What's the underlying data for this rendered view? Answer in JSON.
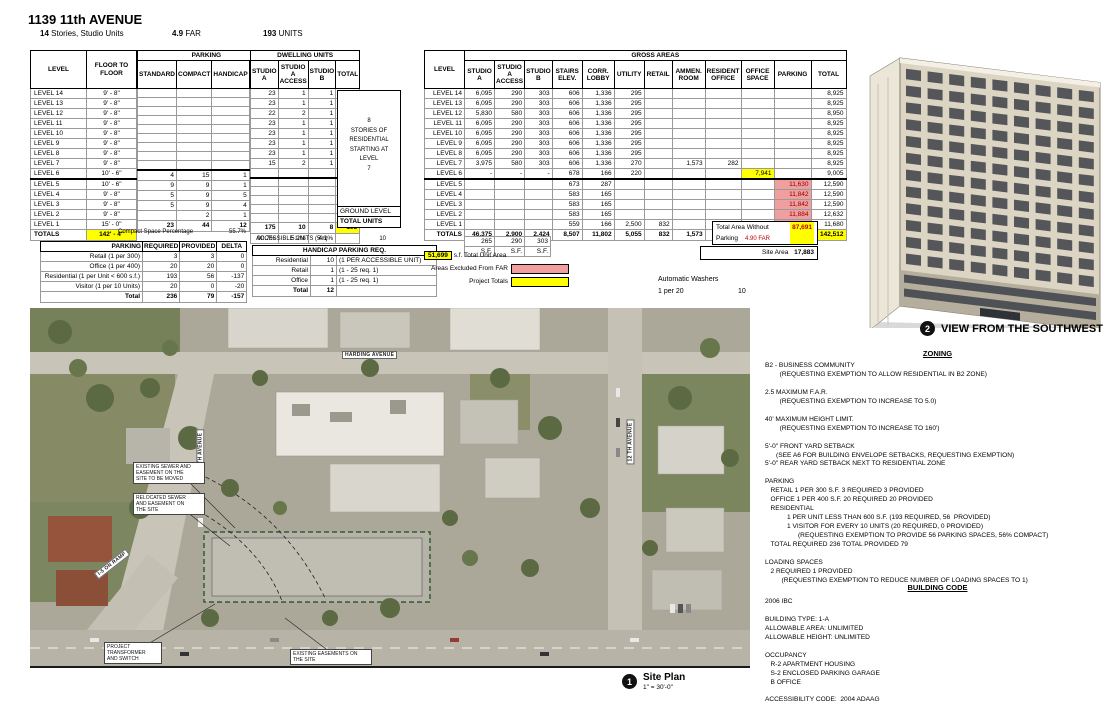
{
  "header": {
    "title": "1139 11th AVENUE",
    "stories_value": "14",
    "stories_label": "Stories, Studio Units",
    "far_value": "4.9",
    "far_label": "FAR",
    "units_value": "193",
    "units_label": "UNITS"
  },
  "tables": {
    "levels": {
      "col_level": "LEVEL",
      "col_floor": "FLOOR TO\nFLOOR",
      "rows": [
        [
          "LEVEL 14",
          "9' - 8\""
        ],
        [
          "LEVEL 13",
          "9' - 8\""
        ],
        [
          "LEVEL 12",
          "9' - 8\""
        ],
        [
          "LEVEL 11",
          "9' - 8\""
        ],
        [
          "LEVEL 10",
          "9' - 8\""
        ],
        [
          "LEVEL 9",
          "9' - 8\""
        ],
        [
          "LEVEL 8",
          "9' - 8\""
        ],
        [
          "LEVEL 7",
          "9' - 8\""
        ],
        [
          "LEVEL 6",
          "10' - 6\""
        ],
        {
          "c": "brk",
          "cells": [
            "LEVEL 5",
            "10' - 6\""
          ]
        },
        [
          "LEVEL 4",
          "9' - 8\""
        ],
        [
          "LEVEL 3",
          "9' - 8\""
        ],
        [
          "LEVEL 2",
          "9' - 8\""
        ],
        [
          "LEVEL 1",
          "15' - 0\""
        ],
        {
          "c": "tot",
          "cells": [
            "TOTALS",
            {
              "v": "142' - 4\"",
              "c": "hl-y"
            }
          ]
        }
      ]
    },
    "parking": {
      "title": "PARKING",
      "columns": [
        "STANDARD",
        "COMPACT",
        "HANDICAP",
        ""
      ],
      "rows": [
        [
          "",
          "",
          "",
          ""
        ],
        [
          "",
          "",
          "",
          ""
        ],
        [
          "",
          "",
          "",
          ""
        ],
        [
          "",
          "",
          "",
          ""
        ],
        [
          "",
          "",
          "",
          ""
        ],
        [
          "",
          "",
          "",
          ""
        ],
        [
          "",
          "",
          "",
          ""
        ],
        [
          "",
          "",
          "",
          ""
        ],
        [
          "",
          "",
          "",
          ""
        ],
        {
          "c": "brk",
          "cells": [
            "4",
            "15",
            "1",
            "20"
          ]
        },
        [
          "9",
          "9",
          "1",
          "19"
        ],
        [
          "5",
          "9",
          "5",
          "19"
        ],
        [
          "5",
          "9",
          "4",
          "18"
        ],
        [
          "",
          "2",
          "1",
          "3"
        ],
        {
          "c": "tot",
          "cells": [
            "23",
            "44",
            "12",
            {
              "v": "79",
              "c": "hl-y"
            }
          ]
        }
      ],
      "compact_label": "Compact Space Percentage",
      "compact_value": "55.7%"
    },
    "dwelling": {
      "title": "DWELLING UNITS",
      "columns": [
        "STUDIO\nA",
        "STUDIO\nA\nACCESS",
        "STUDIO\nB",
        "TOTAL"
      ],
      "rows": [
        [
          "23",
          "1",
          "1",
          "25"
        ],
        [
          "23",
          "1",
          "1",
          "25"
        ],
        [
          "22",
          "2",
          "1",
          "25"
        ],
        [
          "23",
          "1",
          "1",
          "25"
        ],
        [
          "23",
          "1",
          "1",
          "25"
        ],
        [
          "23",
          "1",
          "1",
          "25"
        ],
        [
          "23",
          "1",
          "1",
          "25"
        ],
        [
          "15",
          "2",
          "1",
          "18"
        ],
        [
          "",
          "",
          "",
          ""
        ],
        {
          "c": "brk",
          "cells": [
            "",
            "",
            "",
            ""
          ]
        },
        [
          "",
          "",
          "",
          ""
        ],
        [
          "",
          "",
          "",
          ""
        ],
        [
          "",
          "",
          "",
          ""
        ],
        [
          "",
          "",
          "",
          ""
        ],
        {
          "c": "tot",
          "cells": [
            "175",
            "10",
            "8",
            {
              "v": "193",
              "c": "hl-y"
            }
          ]
        },
        {
          "c": "pct",
          "cells": [
            "90.7%",
            "5.2%",
            "4.1%",
            ""
          ]
        }
      ],
      "note": "8\nSTORIES OF\nRESIDENTIAL\nSTARTING AT\nLEVEL\n7",
      "ground_label": "GROUND LEVEL",
      "total_units_label": "TOTAL UNITS"
    },
    "parking_req": {
      "columns": [
        "PARKING",
        "REQUIRED",
        "PROVIDED",
        "DELTA"
      ],
      "rows": [
        [
          "Retail (1 per 300)",
          "3",
          "3",
          "0"
        ],
        [
          "Office (1 per 400)",
          "20",
          "20",
          "0"
        ],
        [
          "Residential (1 per Unit < 600 s.f.)",
          "193",
          "56",
          "-137"
        ],
        [
          "Visitor (1 per 10 Units)",
          "20",
          "0",
          "-20"
        ],
        {
          "c": "tot",
          "cells": [
            "Total",
            "236",
            "79",
            "-157"
          ]
        }
      ]
    },
    "accessible": {
      "label": "ACCESSIBLE UNITS (5%)",
      "value": "10"
    },
    "handicap": {
      "title": "HANDICAP PARKING REQ.",
      "rows": [
        [
          "Residential",
          "10",
          "(1 PER ACCESSIBLE UNIT)"
        ],
        [
          "Retail",
          "1",
          "(1 - 25 req. 1)"
        ],
        [
          "Office",
          "1",
          "(1 - 25 req. 1)"
        ],
        {
          "c": "tot",
          "cells": [
            "Total",
            "12",
            ""
          ]
        }
      ]
    },
    "gross": {
      "title": "GROSS AREAS",
      "col_level": "LEVEL",
      "columns": [
        "STUDIO\nA",
        "STUDIO\nA\nACCESS",
        "STUDIO\nB",
        "STAIRS\nELEV.",
        "CORR.\nLOBBY",
        "UTILITY",
        "RETAIL",
        "AMMEN.\nROOM",
        "RESIDENT\nOFFICE",
        "OFFICE\nSPACE",
        "PARKING",
        "TOTAL"
      ],
      "rows": [
        [
          "LEVEL 14",
          "6,095",
          "290",
          "303",
          "606",
          "1,336",
          "295",
          "",
          "",
          "",
          "",
          "",
          "8,925"
        ],
        [
          "LEVEL 13",
          "6,095",
          "290",
          "303",
          "606",
          "1,336",
          "295",
          "",
          "",
          "",
          "",
          "",
          "8,925"
        ],
        [
          "LEVEL 12",
          "5,830",
          "580",
          "303",
          "606",
          "1,336",
          "295",
          "",
          "",
          "",
          "",
          "",
          "8,950"
        ],
        [
          "LEVEL 11",
          "6,095",
          "290",
          "303",
          "606",
          "1,336",
          "295",
          "",
          "",
          "",
          "",
          "",
          "8,925"
        ],
        [
          "LEVEL 10",
          "6,095",
          "290",
          "303",
          "606",
          "1,336",
          "295",
          "",
          "",
          "",
          "",
          "",
          "8,925"
        ],
        [
          "LEVEL 9",
          "6,095",
          "290",
          "303",
          "606",
          "1,336",
          "295",
          "",
          "",
          "",
          "",
          "",
          "8,925"
        ],
        [
          "LEVEL 8",
          "6,095",
          "290",
          "303",
          "606",
          "1,336",
          "295",
          "",
          "",
          "",
          "",
          "",
          "8,925"
        ],
        [
          "LEVEL 7",
          "3,975",
          "580",
          "303",
          "606",
          "1,336",
          "270",
          "",
          "1,573",
          "282",
          "",
          "",
          "8,925"
        ],
        [
          "LEVEL 6",
          "-",
          "-",
          "-",
          "678",
          "166",
          "220",
          "",
          "",
          "",
          {
            "v": "7,941",
            "c": "hl-y"
          },
          "",
          "9,005"
        ],
        {
          "c": "brk",
          "cells": [
            "LEVEL 5",
            "",
            "",
            "",
            "673",
            "287",
            "",
            "",
            "",
            "",
            "",
            {
              "v": "11,630",
              "c": "hl-r"
            },
            "12,590"
          ]
        },
        [
          "LEVEL 4",
          "",
          "",
          "",
          "583",
          "165",
          "",
          "",
          "",
          "",
          "",
          {
            "v": "11,842",
            "c": "hl-r"
          },
          "12,590"
        ],
        [
          "LEVEL 3",
          "",
          "",
          "",
          "583",
          "165",
          "",
          "",
          "",
          "",
          "",
          {
            "v": "11,842",
            "c": "hl-r"
          },
          "12,590"
        ],
        [
          "LEVEL 2",
          "",
          "",
          "",
          "583",
          "165",
          "",
          "",
          "",
          "",
          "",
          {
            "v": "11,884",
            "c": "hl-r"
          },
          "12,632"
        ],
        [
          "LEVEL 1",
          "",
          "",
          "",
          "559",
          "166",
          "2,500",
          "832",
          "",
          "",
          "",
          {
            "v": "7,623",
            "c": "hl-r"
          },
          "11,680"
        ],
        {
          "c": "tot",
          "cells": [
            "TOTALS",
            "46,375",
            "2,900",
            "2,424",
            "8,507",
            "11,802",
            "5,055",
            "832",
            "1,573",
            "282",
            "7,941",
            {
              "v": "54,821",
              "c": "hl-r"
            },
            {
              "v": "142,512",
              "c": "hl-y"
            }
          ]
        }
      ],
      "sf_rows": [
        [
          "265",
          "290",
          "303"
        ],
        [
          "S.F.",
          "S.F.",
          "S.F."
        ]
      ]
    }
  },
  "summary": {
    "total_area_label": "Total Area Without Parking",
    "total_area_value": "87,691",
    "far_note": "4.90 FAR",
    "site_area_label": "Site Area",
    "site_area_value": "17,883",
    "unit_area_value": "51,699",
    "unit_area_label": "s.f. Total Unit Area",
    "legend_excluded": "Areas Excluded From FAR",
    "legend_totals": "Project Totals",
    "washers_label": "Automatic Washers",
    "washers_ratio": "1 per 20",
    "washers_value": "10",
    "colors": {
      "highlight_yellow": "#ffff00",
      "excluded_pink": "#f19e9e"
    }
  },
  "view_caption": {
    "num": "2",
    "label": "VIEW FROM THE SOUTHWEST"
  },
  "site_caption": {
    "num": "1",
    "label": "Site Plan",
    "scale": "1\" = 30'-0\""
  },
  "site_plan": {
    "street_harding": "HARDING AVENUE",
    "street_11th": "11 TH AVENUE",
    "street_12th": "12 TH AVENUE",
    "ramp": "I-5 ON RAMP",
    "ann_sewer_existing": "EXISTING SEWER AND\nEASEMENT ON THE\nSITE TO BE MOVED",
    "ann_sewer_relocated": "RELOCATED SEWER\nAND EASEMENT ON\nTHE SITE",
    "ann_transformer": "PROJECT\nTRANSFORMER\nAND SWITCH",
    "ann_easements": "EXISTING EASEMENTS ON\nTHE SITE"
  },
  "zoning": {
    "title": "ZONING",
    "body": "B2 - BUSINESS COMMUNITY\n        (REQUESTING EXEMPTION TO ALLOW RESIDENTIAL IN B2 ZONE)\n\n2.5 MAXIMUM F.A.R.\n        (REQUESTING EXEMPTION TO INCREASE TO 5.0)\n\n40' MAXIMUM HEIGHT LIMIT.\n        (REQUESTING EXEMPTION TO INCREASE TO 160')\n\n5'-0\" FRONT YARD SETBACK\n      (SEE A6 FOR BUILDING ENVELOPE SETBACKS, REQUESTING EXEMPTION)\n5'-0\" REAR YARD SETBACK NEXT TO RESIDENTIAL ZONE\n\nPARKING\n   RETAIL 1 PER 300 S.F. 3 REQUIRED 3 PROVIDED\n   OFFICE 1 PER 400 S.F. 20 REQUIRED 20 PROVIDED\n   RESIDENTIAL\n            1 PER UNIT LESS THAN 600 S.F. (193 REQUIRED, 56  PROVIDED)\n            1 VISITOR FOR EVERY 10 UNITS (20 REQUIRED, 0 PROVIDED)\n                  (REQUESTING EXEMPTION TO PROVIDE 56 PARKING SPACES, 56% COMPACT)\n   TOTAL REQUIRED 236 TOTAL PROVIDED 79\n\nLOADING SPACES\n   2 REQUIRED 1 PROVIDED\n         (REQUESTING EXEMPTION TO REDUCE NUMBER OF LOADING SPACES TO 1)"
  },
  "building_code": {
    "title": "BUILDING CODE",
    "body": "2006 IBC\n\nBUILDING TYPE: 1-A\nALLOWABLE AREA: UNLIMITED\nALLOWABLE HEIGHT: UNLIMITED\n\nOCCUPANCY\n   R-2 APARTMENT HOUSING\n   S-2 ENCLOSED PARKING GARAGE\n   B OFFICE\n\nACCESSIBILITY CODE:  2004 ADAAG"
  }
}
